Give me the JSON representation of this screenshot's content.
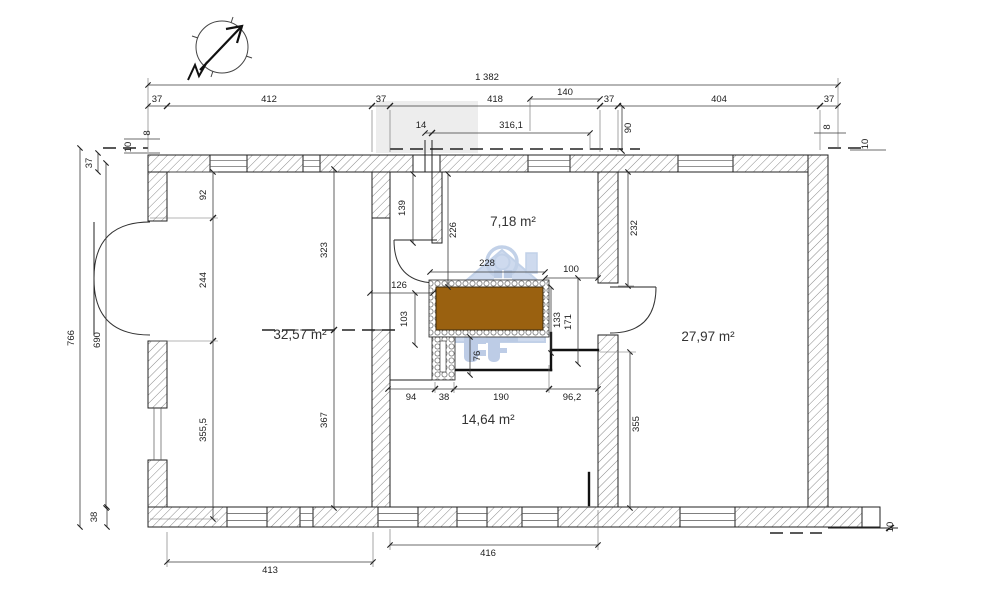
{
  "drawing": {
    "kind": "architectural floor plan",
    "units": "cm"
  },
  "rooms": [
    {
      "id": "room-left",
      "area": "32,57 m²"
    },
    {
      "id": "room-top-middle",
      "area": "7,18 m²"
    },
    {
      "id": "room-right",
      "area": "27,97 m²"
    },
    {
      "id": "room-bottom-middle",
      "area": "14,64 m²"
    }
  ],
  "dims": {
    "total_width": "1 382",
    "top": {
      "a37": "37",
      "a412": "412",
      "b37": "37",
      "a418": "418",
      "a140": "140",
      "c37": "37",
      "a404": "404",
      "d37": "37"
    },
    "sub": {
      "a14": "14",
      "a316": "316,1",
      "a90": "90"
    },
    "corner": {
      "tl8": "8",
      "tl10": "10",
      "tr8": "8",
      "tr10": "10",
      "br10": "10"
    },
    "left": {
      "h766": "766",
      "h37": "37",
      "h690": "690",
      "h92": "92",
      "h244": "244",
      "h3555": "355,5",
      "h38": "38"
    },
    "mid": {
      "h323": "323",
      "h367": "367"
    },
    "bottom": {
      "w413": "413",
      "w416": "416"
    },
    "hall": {
      "h139": "139",
      "h226": "226",
      "w228": "228",
      "w100": "100",
      "w126": "126",
      "h103": "103",
      "h133": "133",
      "h171": "171",
      "h76": "76"
    },
    "broom": {
      "w94": "94",
      "w38": "38",
      "w190": "190",
      "w962": "96,2",
      "h355": "355"
    },
    "right": {
      "h232": "232"
    }
  },
  "colors": {
    "stove_fill": "#9a6110",
    "watermark_blue": "#8ba9d8",
    "shaded_area": "#ededed",
    "line": "#222222"
  },
  "icons": {
    "compass": "north-arrow",
    "watermark": "house-and-keys-logo"
  }
}
